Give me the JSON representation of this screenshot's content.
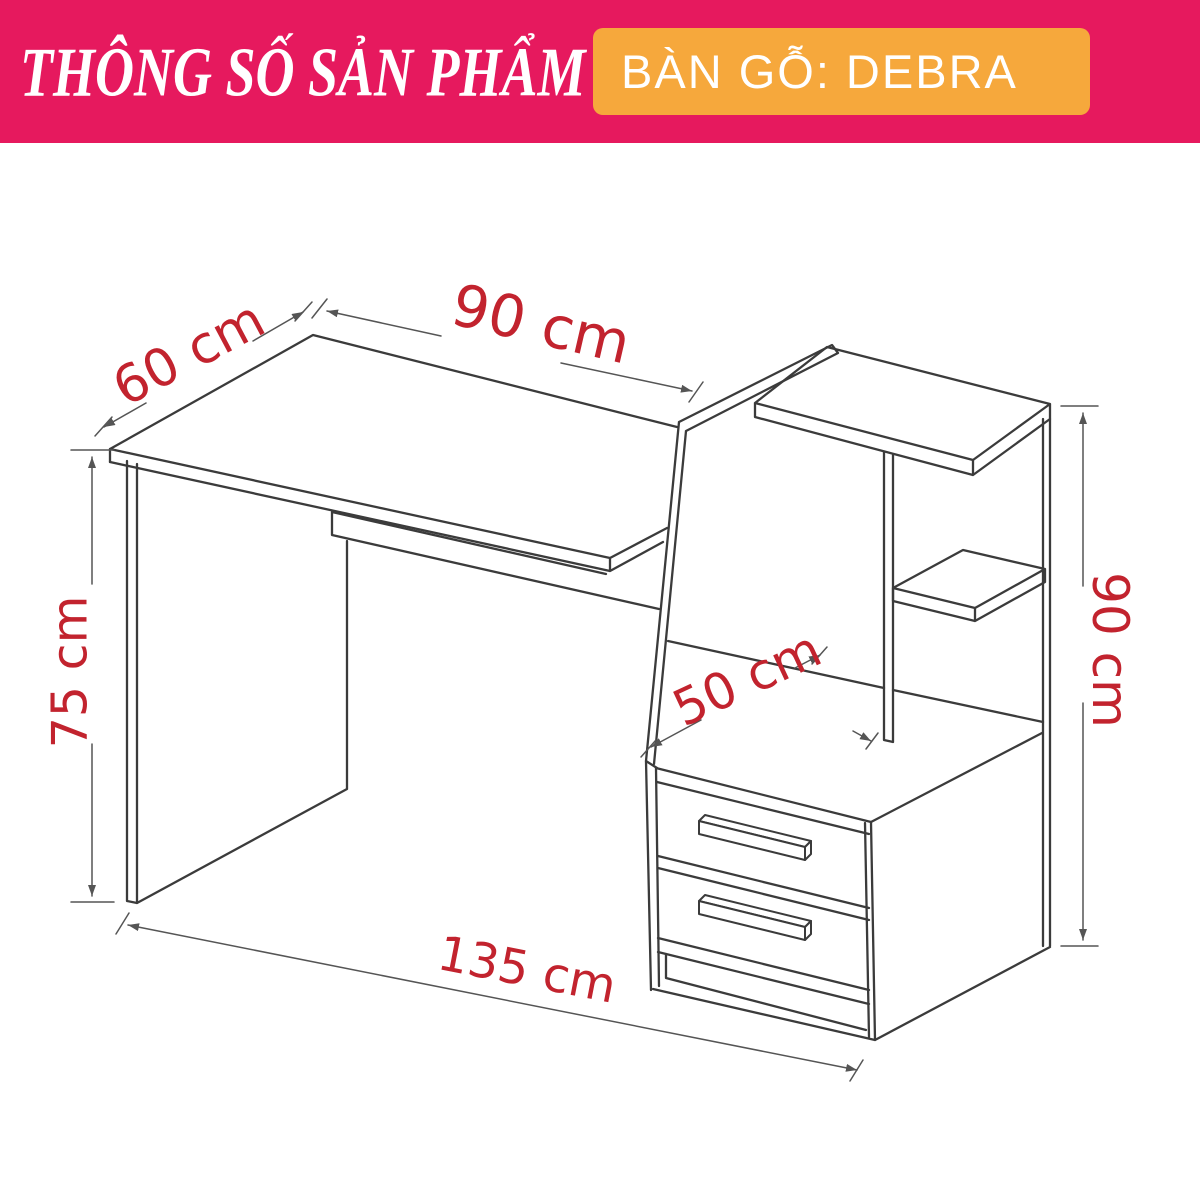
{
  "header": {
    "title": "THÔNG SỐ SẢN PHẨM",
    "product_label": "BÀN GỖ: DEBRA"
  },
  "colors": {
    "banner": "#E6195E",
    "badge": "#F6A83C",
    "dimension": "#C2232E",
    "line": "#3B3B3B",
    "dim-line": "#555555",
    "background": "#FFFFFF",
    "text": "#FFFFFF"
  },
  "diagram": {
    "dimensions": {
      "desk_depth": "60 cm",
      "desk_width": "90 cm",
      "desk_height": "75 cm",
      "cabinet_depth": "50 cm",
      "shelf_height": "90 cm",
      "total_width": "135 cm"
    }
  }
}
